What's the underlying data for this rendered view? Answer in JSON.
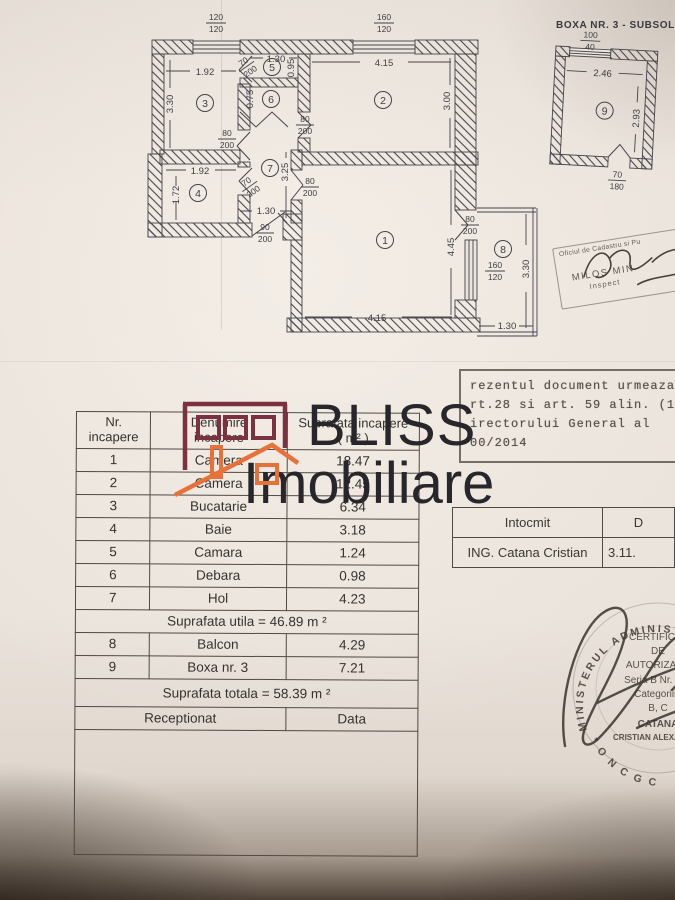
{
  "logo": {
    "word1": "BLISS",
    "word2": "Imobiliare",
    "brand_maroon": "#7c3140",
    "brand_orange": "#e8713a",
    "ink": "#26262b"
  },
  "floorplan": {
    "boxa_title": "BOXA NR. 3 - SUBSOL",
    "rooms": {
      "r1": "1",
      "r2": "2",
      "r3": "3",
      "r4": "4",
      "r5": "5",
      "r6": "6",
      "r7": "7",
      "r8": "8",
      "r9": "9"
    },
    "dims": {
      "w1": {
        "a": "120",
        "b": "120"
      },
      "w2": {
        "a": "160",
        "b": "120"
      },
      "r3w": "1.92",
      "r3h": "3.30",
      "r5w": "1.30",
      "r5h": "0.95",
      "d5": {
        "a": "70",
        "b": "200"
      },
      "r6h": "0.75",
      "r2w": "4.15",
      "r2h": "3.00",
      "d2": {
        "a": "80",
        "b": "200"
      },
      "dh1": {
        "a": "80",
        "b": "200"
      },
      "r4w": "1.92",
      "r4h": "1.72",
      "d4": {
        "a": "70",
        "b": "200"
      },
      "r7h": "3.25",
      "dh2": {
        "a": "80",
        "b": "200"
      },
      "entw": "1.30",
      "ent": {
        "a": "90",
        "b": "200"
      },
      "r1h": "4.45",
      "r1w": "4.15",
      "d8": {
        "a": "80",
        "b": "200"
      },
      "w8": {
        "a": "160",
        "b": "120"
      },
      "r8h": "3.30",
      "r8w": "1.30",
      "r9w": "2.46",
      "r9h": "2.93",
      "w9": {
        "a": "100",
        "b": "40"
      },
      "d9": {
        "a": "70",
        "b": "180"
      }
    }
  },
  "table": {
    "headers": {
      "c1a": "Nr.",
      "c1b": "incapere",
      "c2a": "Denumire",
      "c2b": "incapere",
      "c3a": "Suprafata incapere",
      "c3b": "( m² )"
    },
    "rows": [
      {
        "nr": "1",
        "name": "Camera",
        "area": "18.47"
      },
      {
        "nr": "2",
        "name": "Camera",
        "area": "12.45"
      },
      {
        "nr": "3",
        "name": "Bucatarie",
        "area": "6.34"
      },
      {
        "nr": "4",
        "name": "Baie",
        "area": "3.18"
      },
      {
        "nr": "5",
        "name": "Camara",
        "area": "1.24"
      },
      {
        "nr": "6",
        "name": "Debara",
        "area": "0.98"
      },
      {
        "nr": "7",
        "name": "Hol",
        "area": "4.23"
      }
    ],
    "subtotal": "Suprafata utila =  46.89 m ²",
    "rows2": [
      {
        "nr": "8",
        "name": "Balcon",
        "area": "4.29"
      },
      {
        "nr": "9",
        "name": "Boxa nr. 3",
        "area": "7.21"
      }
    ],
    "total": "Suprafata totala = 58.39 m ²",
    "reception": "Receptionat",
    "data_label": "Data"
  },
  "intocmit": {
    "c1": "Intocmit",
    "c2": "D",
    "name": "ING. Catana Cristian",
    "date": "3.11."
  },
  "stamp_office": {
    "line1": "Oficiul de Cadastru si Pu",
    "line2": "MILOS MIN",
    "line3": "Inspect"
  },
  "stamp_typed": {
    "line1": "rezentul document urmeaza",
    "line2": "rt.28 si art. 59 alin. (1)",
    "line3": "irectorului General al",
    "line4": "00/2014"
  },
  "stamp_round": {
    "ring_left": "MINISTERUL ADMINISTRATIEI",
    "ring_bottom": "* O N C G C",
    "l1": "CERTIFICAT",
    "l2": "DE",
    "l3": "AUTORIZARE",
    "l4": "Seria B Nr. 685",
    "l5": "Categoriile",
    "l6": "B, C",
    "l7": "CATANA",
    "l8": "CRISTIAN ALEXANDRU"
  }
}
